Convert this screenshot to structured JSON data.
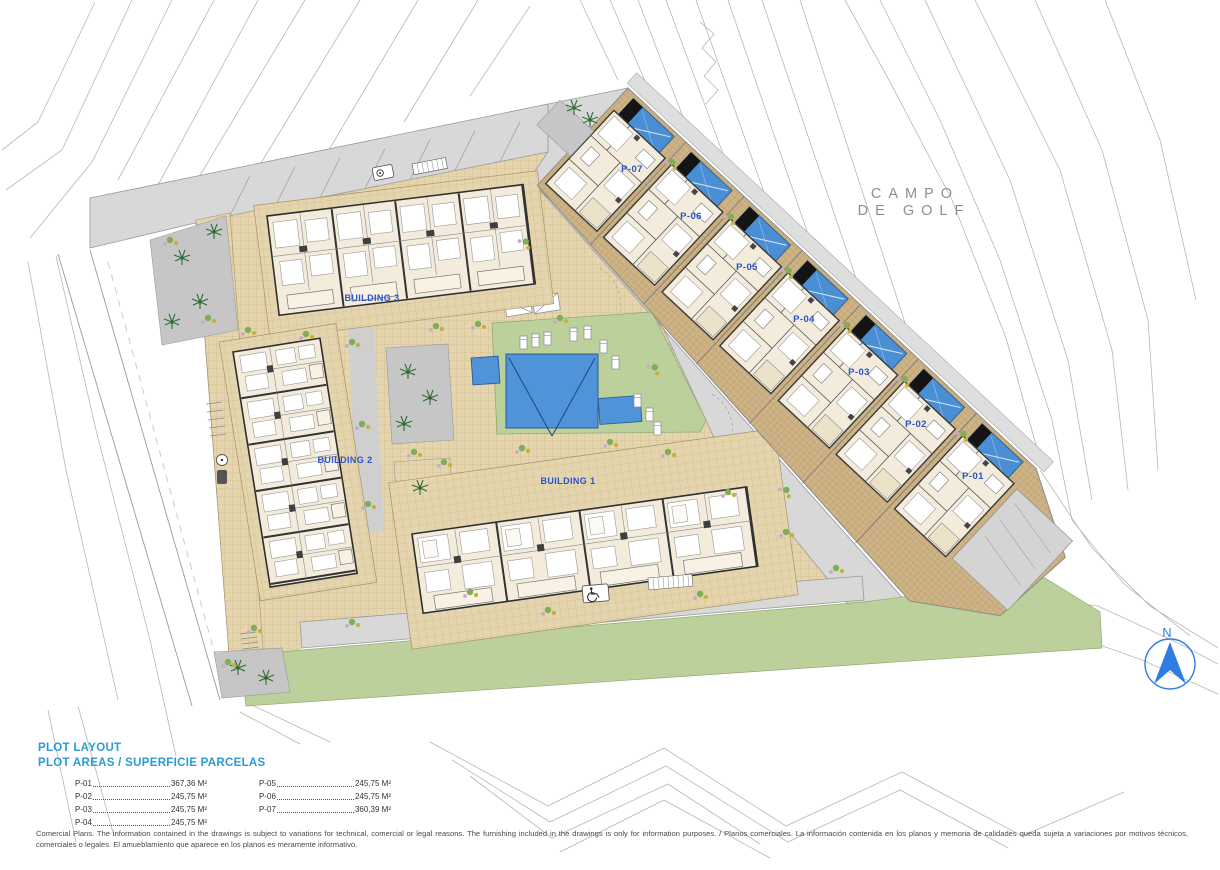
{
  "plan": {
    "golf_area": {
      "line1": "CAMPO",
      "line2": "DE GOLF"
    },
    "compass": {
      "label": "N"
    },
    "buildings": [
      {
        "label": "BUILDING 1"
      },
      {
        "label": "BUILDING 2"
      },
      {
        "label": "BUILDING 3"
      }
    ],
    "plots": [
      {
        "label": "P-01"
      },
      {
        "label": "P-02"
      },
      {
        "label": "P-03"
      },
      {
        "label": "P-04"
      },
      {
        "label": "P-05"
      },
      {
        "label": "P-06"
      },
      {
        "label": "P-07"
      }
    ]
  },
  "legend": {
    "title": "PLOT LAYOUT",
    "subtitle": "PLOT AREAS / SUPERFICIE PARCELAS",
    "columns": [
      {
        "rows": [
          {
            "plot": "P-01",
            "area": "367,36 M²"
          },
          {
            "plot": "P-02",
            "area": "245,75 M²"
          },
          {
            "plot": "P-03",
            "area": "245,75 M²"
          },
          {
            "plot": "P-04",
            "area": "245,75 M²"
          }
        ]
      },
      {
        "rows": [
          {
            "plot": "P-05",
            "area": "245,75 M²"
          },
          {
            "plot": "P-06",
            "area": "245,75 M²"
          },
          {
            "plot": "P-07",
            "area": "360,39 M²"
          }
        ]
      }
    ]
  },
  "disclaimer": "Comercial Plans. The information contained in the drawings is subject to variations for technical, comercial or legal reasons. The furnishing included in the drawings is only for information purposes. / Planos comerciales. La información contenida en los planos y memoria de calidades queda sujeta a variaciones por motivos técnicos, comerciales o legales. El amueblamiento que aparece en los planos es meramente informativo.",
  "colors": {
    "plan_label_blue": "#2b52c8",
    "legend_blue": "#2d9bd3",
    "pool_blue": "#4a8fd4",
    "compass_blue": "#2f7de1",
    "terrace_tan": "#cdb386",
    "lawn_green": "#bcd09c",
    "road_gray": "#d8d8d8"
  }
}
